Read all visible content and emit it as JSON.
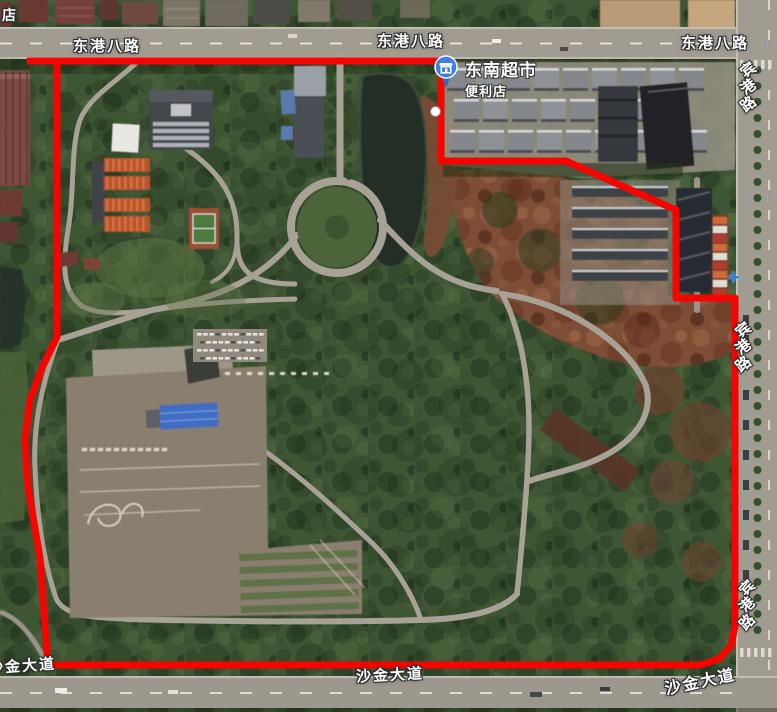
{
  "canvas": {
    "width": 777,
    "height": 712
  },
  "labels": {
    "road_top_name": "东港八路",
    "road_right_name": "宾港路",
    "road_bottom_name": "沙金大道",
    "corner_partial_text": "店"
  },
  "poi": {
    "title": "东南超市",
    "subtitle": "便利店",
    "icon": "shop-pin-icon",
    "pin_color": "#3d7de6"
  },
  "markers": {
    "plus_sign": "+",
    "arrow_down": "↓",
    "arrow_up": "↑"
  },
  "boundary": {
    "color": "#f50400",
    "stroke_width": 7,
    "points": [
      [
        27,
        61
      ],
      [
        441,
        61
      ],
      [
        441,
        161
      ],
      [
        566,
        161
      ],
      [
        676,
        210
      ],
      [
        676,
        298
      ],
      [
        735,
        298
      ],
      [
        735,
        626
      ],
      [
        731,
        646
      ],
      [
        719,
        659
      ],
      [
        700,
        665
      ],
      [
        48,
        665
      ],
      [
        40,
        558
      ],
      [
        28,
        487
      ],
      [
        25,
        440
      ],
      [
        30,
        400
      ],
      [
        42,
        368
      ],
      [
        57,
        337
      ],
      [
        57,
        61
      ]
    ]
  },
  "palette": {
    "label_white": "#ffffff",
    "forest_green": "#3f5634",
    "dirt_brown": "#7e4e36",
    "road_gray": "#a19c92"
  }
}
